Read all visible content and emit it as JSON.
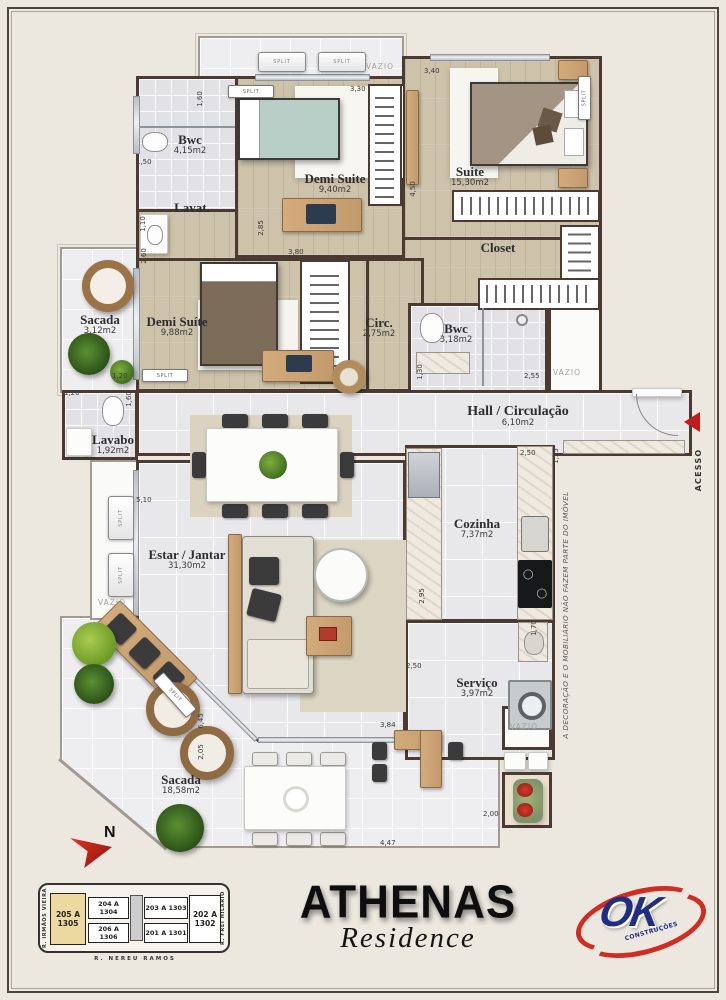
{
  "plan": {
    "rooms": [
      {
        "name": "Bwc",
        "area": "4,15m2"
      },
      {
        "name": "Demi Suite",
        "area": "9,40m2"
      },
      {
        "name": "Suite",
        "area": "15,30m2"
      },
      {
        "name": "Closet",
        "area": ""
      },
      {
        "name": "Lavat.",
        "area": ""
      },
      {
        "name": "Sacada",
        "area": "3,12m2"
      },
      {
        "name": "Demi Suíte",
        "area": "9,88m2"
      },
      {
        "name": "Circ.",
        "area": "2,75m2"
      },
      {
        "name": "Bwc",
        "area": "3,18m2"
      },
      {
        "name": "Hall / Circulação",
        "area": "6,10m2"
      },
      {
        "name": "Lavabo",
        "area": "1,92m2"
      },
      {
        "name": "Estar / Jantar",
        "area": "31,30m2"
      },
      {
        "name": "Cozinha",
        "area": "7,37m2"
      },
      {
        "name": "Serviço",
        "area": "3,97m2"
      },
      {
        "name": "Sacada",
        "area": "18,58m2"
      }
    ],
    "dims": [
      "1,60",
      "1,50",
      "3,30",
      "3,40",
      "4,50",
      "1,10",
      "2,60",
      "2,85",
      "3,80",
      "1,30",
      "2,55",
      "1,20",
      "1,20",
      "1,60",
      "5,10",
      "2,50",
      "1,35",
      "2,95",
      "2,50",
      "1,70",
      "1,20",
      "6,45",
      "2,05",
      "3,84",
      "2,00",
      "4,47"
    ],
    "tags": {
      "vazio": "VAZIO",
      "split": "SPLIT",
      "acesso": "ACESSO",
      "north": "N"
    },
    "disclaimer": "A DECORAÇÃO E O MOBILIÁRIO NÃO FAZEM PARTE DO IMÓVEL"
  },
  "branding": {
    "title": "ATHENAS",
    "subtitle": "Residence",
    "ok": "OK",
    "ok_sub": "CONSTRUÇÕES"
  },
  "keyplan": {
    "streets": {
      "left": "R. IRMÃOS VIEIRA",
      "right": "R. FREI HILÁRIO",
      "bottom": "R. NEREU RAMOS"
    },
    "units": [
      {
        "label": "205 A 1305"
      },
      {
        "label": "204 A 1304"
      },
      {
        "label": "203 A 1303"
      },
      {
        "label": "202 A 1302"
      },
      {
        "label": "206 A 1306"
      },
      {
        "label": "201 A 1301"
      }
    ]
  },
  "colors": {
    "wall": "#4a3a31",
    "wood_floor": "#cdc2aa",
    "tile_floor": "#e8e8eb",
    "accent_red": "#c41a1a",
    "ok_blue": "#1f2d86",
    "highlight_unit": "#ecd9a0"
  }
}
